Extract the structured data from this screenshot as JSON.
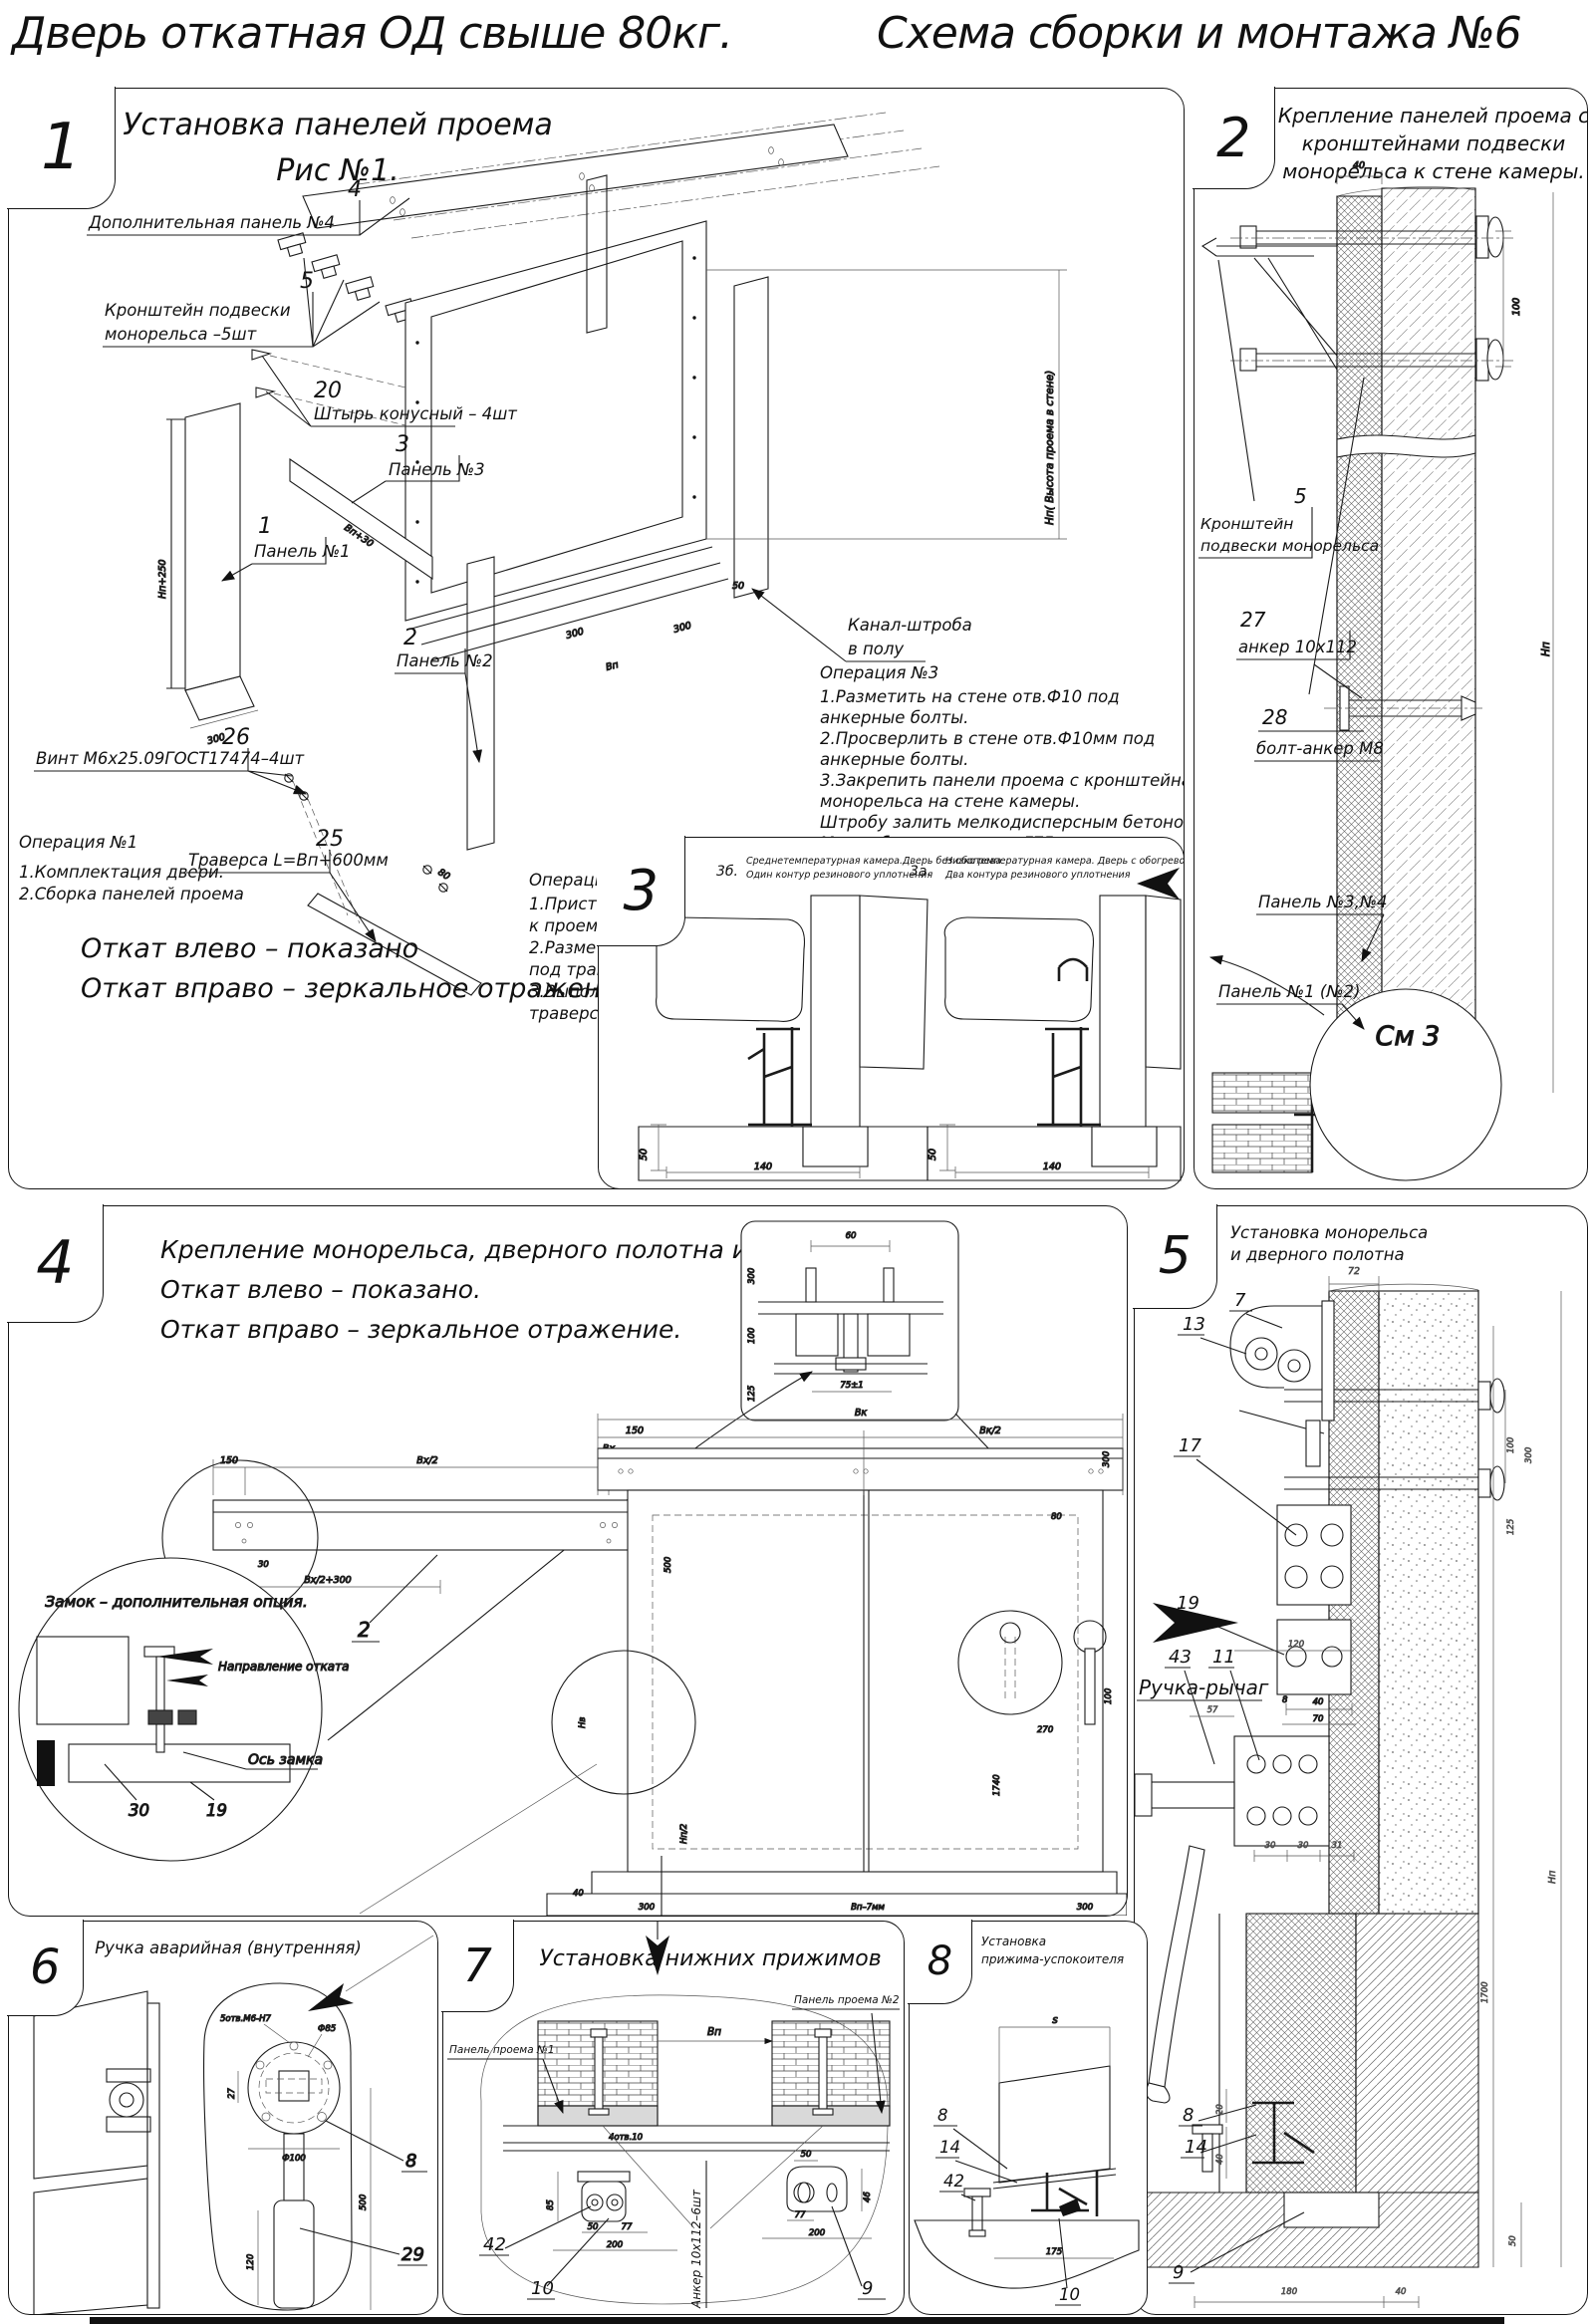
{
  "page": {
    "title_left": "Дверь откатная ОД свыше 80кг.",
    "title_right": "Схема сборки и монтажа №6"
  },
  "s1": {
    "num": "1",
    "title1": "Установка панелей проема",
    "title2": "Рис №1.",
    "c4n": "4",
    "c4": "Дополнительная панель №4",
    "c5n": "5",
    "c5a": "Кронштейн подвески",
    "c5b": "монорельса –5шт",
    "c20n": "20",
    "c20": "Штырь конусный – 4шт",
    "c3n": "3",
    "c3": "Панель №3",
    "c1n": "1",
    "c1": "Панель №1",
    "c2n": "2",
    "c2": "Панель №2",
    "c26n": "26",
    "c26": "Винт М6х25.09ГОСТ17474–4шт",
    "c25n": "25",
    "c25": "Траверса  L=Вп+600мм",
    "kanal1": "Канал-штроба",
    "kanal2": "в полу",
    "op1a": "Операция №1",
    "op1b": "1.Комплектация двери.",
    "op1c": "2.Сборка панелей проема",
    "op2a": "Операция №2",
    "op2b": "1.Приставить собраные панели",
    "op2c": "к проему в стене.",
    "op2d": "2.Разметить на полу контур штробы",
    "op2e": "под траверсу.",
    "op2f": "3.Выполнить в полу штробу под",
    "op2g": "траверсу, глубиной 50мм.",
    "op3a": "Операция №3",
    "op3b": "1.Разметить на стене отв.Ф10 под",
    "op3c": "анкерные болты.",
    "op3d": "2.Просверлить в стене отв.Ф10мм   под",
    "op3e": "анкерные болты.",
    "op3f": "3.Закрепить панели проема с кронштейнами подвески",
    "op3g": "монорельса на стене камеры.",
    "op3h": "Штробу залить мелкодисперсным бетоном",
    "op3i": "Марка бетона не ниже   F75.",
    "otkat1": "Откат влево – показано",
    "otkat2": "Откат вправо – зеркальное отражение.",
    "dimHp": "Нп+250",
    "dim300": "300",
    "dimVp": "Вп+30",
    "dim80": "80",
    "sill300": "300",
    "sillVp": "Вп",
    "sill300b": "300",
    "sill50": "50",
    "hjamb": "Нп( Высота проема в стене)"
  },
  "s2": {
    "num": "2",
    "t1": "Крепление панелей проема с",
    "t2": "кронштейнами  подвески",
    "t3": "монорельса к стене камеры.",
    "c5n": "5",
    "c5a": "Кронштейн",
    "c5b": "подвески монорельса",
    "c28n": "28",
    "c28": "болт-анкер М8",
    "p34": "Панель №3,№4",
    "c27n": "27",
    "c27": "анкер 10х112",
    "p12": "Панель №1 (№2)",
    "sm3": "См 3",
    "d40": "40",
    "d100": "100",
    "dhp": "Нп"
  },
  "s3": {
    "num": "3",
    "bn": "3б.",
    "b1": "Среднетемпературная камера.Дверь без обогрева",
    "b2": "Один контур резинового уплотнения",
    "an": "3а.",
    "a1": "Низкотемпературная камера. Дверь с обогревом проема и порога",
    "a2": "Два контура резинового уплотнения",
    "d50a": "50",
    "d140a": "140",
    "d50b": "50",
    "d140b": "140"
  },
  "s4": {
    "num": "4",
    "t1": "Крепление монорельса, дверного полотна и фурнитуры.",
    "t2": "Откат влево – показано.",
    "t3": "Откат вправо – зеркальное отражение.",
    "l7": "7",
    "l2": "2",
    "zamok": "Замок – дополнительная опция.",
    "napr": "Направление отката",
    "os": "Ось замка",
    "l30": "30",
    "l19": "19",
    "i60": "60",
    "i300": "300",
    "i100": "100",
    "i125": "125",
    "i75": "75±1",
    "r150a": "150",
    "rbx2a": "Вх/2",
    "rbx": "Вх",
    "rbx2b": "Вх/2",
    "r150b": "150",
    "r30": "30",
    "r60": "60",
    "rbx300": "Вх/2+300",
    "e100": "100",
    "e300": "300",
    "e125": "125",
    "d150": "150",
    "dvk": "Вк",
    "dvk2": "Вк/2",
    "d300": "300",
    "d80": "80",
    "d500": "500",
    "d270": "270",
    "d1740": "1740",
    "d100": "100",
    "dnv": "Нв",
    "dnp2": "Нп/2",
    "d40": "40",
    "b300a": "300",
    "bbp": "Вп–7мм",
    "b300b": "300"
  },
  "s5": {
    "num": "5",
    "t1": "Установка монорельса",
    "t2": "и дверного полотна",
    "l7": "7",
    "l13": "13",
    "l17": "17",
    "l19": "19",
    "l43": "43",
    "l11": "11",
    "ruchka": "Ручка-рычаг",
    "l8": "8",
    "l14": "14",
    "l9": "9",
    "d72": "72",
    "d100": "100",
    "d300": "300",
    "d125": "125",
    "d8": "8",
    "d40": "40",
    "d70": "70",
    "d120": "120",
    "d57": "57",
    "d30a": "30",
    "d30b": "30",
    "d31": "31",
    "d20": "20",
    "d40b": "40",
    "d1700": "1700",
    "dnp": "Нп",
    "d50": "50",
    "d180": "180",
    "d40c": "40"
  },
  "s6": {
    "num": "6",
    "t": "Ручка аварийная (внутренняя)",
    "l8": "8",
    "l29": "29",
    "otv": "5отв.М6-Н7",
    "f85": "Ф85",
    "f100": "Ф100",
    "d27": "27",
    "d500": "500",
    "d120": "120"
  },
  "s7": {
    "num": "7",
    "t": "Установка  нижних  прижимов",
    "p1": "Панель проема №1",
    "p2": "Панель проема №2",
    "l42": "42",
    "l10": "10",
    "l9": "9",
    "anker": "Анкер  10х112–6шт",
    "otv": "4отв.10",
    "dbp": "Вп",
    "d85": "85",
    "d50a": "50",
    "d77a": "77",
    "d200a": "200",
    "d50b": "50",
    "d46": "46",
    "d77b": "77",
    "d200b": "200"
  },
  "s8": {
    "num": "8",
    "t1": "Установка",
    "t2": "прижима-успокоителя",
    "l8": "8",
    "l14": "14",
    "l42": "42",
    "l10": "10",
    "ds": "s",
    "d175": "175"
  }
}
